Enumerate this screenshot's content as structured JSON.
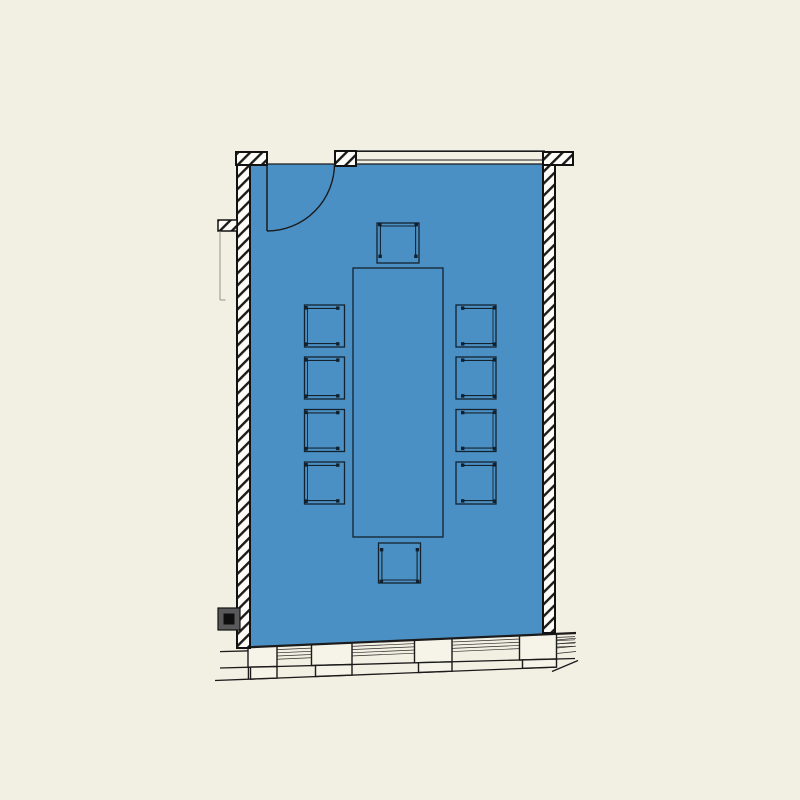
{
  "plan": {
    "type": "floor-plan",
    "room": {
      "kind": "conference-room",
      "selected": true,
      "chair_count": 10,
      "table_count": 1,
      "door_count": 1,
      "column_count": 1,
      "window_mullion_count": 4
    },
    "colors": {
      "background": "#F2EFE3",
      "room_fill": "#4B90C4",
      "line": "#1B1B1B",
      "wall_fill": "#FDFCF6",
      "column_fill": "#59595B",
      "column_core": "#0E0E0E",
      "leader_line": "#8B8B84"
    }
  }
}
